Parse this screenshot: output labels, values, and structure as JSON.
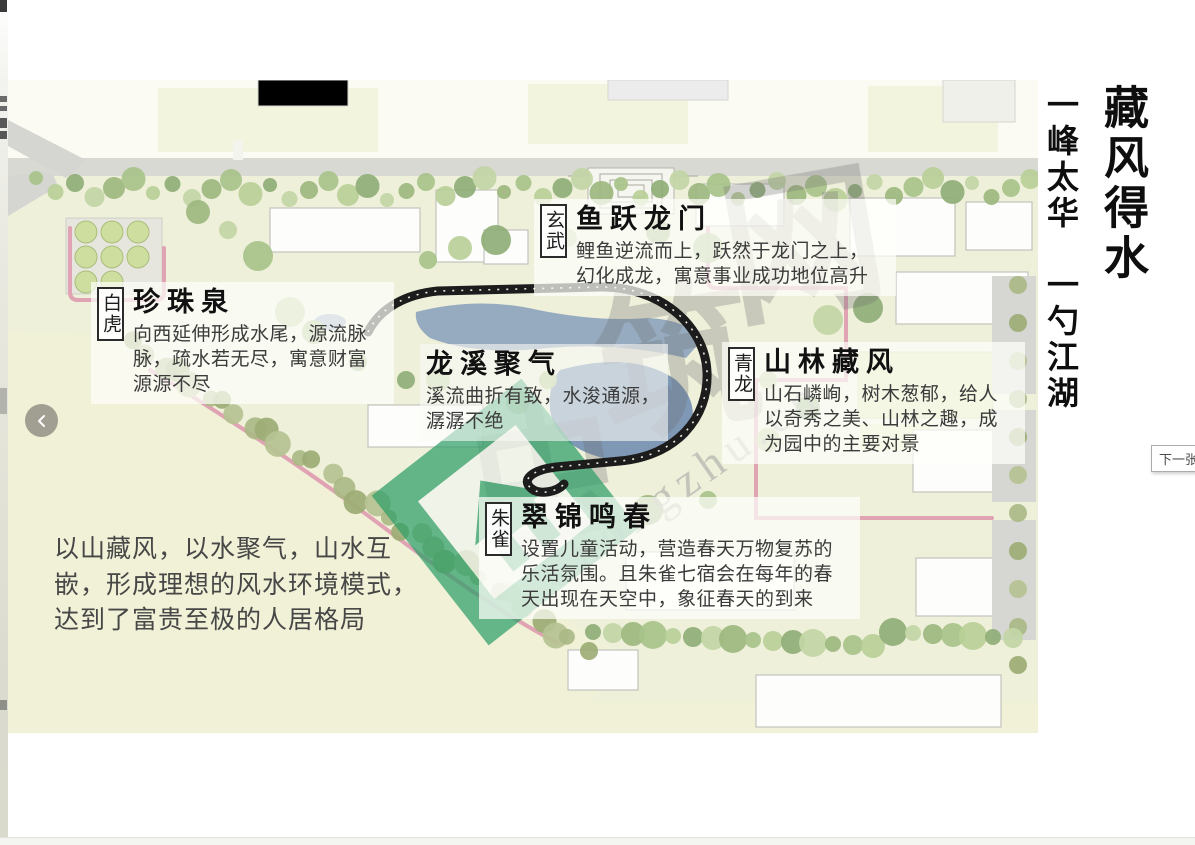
{
  "page": {
    "main_title": "藏风得水",
    "subtitle": "一峰太华　一勺江湖",
    "prev_button_symbol": "‹",
    "next_button_label": "下一张"
  },
  "annotations": {
    "xuanwu": {
      "badge": "玄武",
      "title": "鱼跃龙门",
      "body": "鲤鱼逆流而上，跃然于龙门之上，\n幻化成龙，寓意事业成功地位高升"
    },
    "baihu": {
      "badge": "白虎",
      "title": "珍珠泉",
      "body": "向西延伸形成水尾，源流脉\n脉，疏水若无尽，寓意财富\n源源不尽"
    },
    "longxi": {
      "title": "龙溪聚气",
      "body": "溪流曲折有致，水浚通源，\n潺潺不绝"
    },
    "qinglong": {
      "badge": "青龙",
      "title": "山林藏风",
      "body": "山石嶙峋，树木葱郁，给人\n以奇秀之美、山林之趣，成\n为园中的主要对景"
    },
    "zhuque": {
      "badge": "朱雀",
      "title": "翠锦鸣春",
      "body": "设置儿童活动，营造春天万物复苏的\n乐活氛围。且朱雀七宿会在每年的春\n天出现在天空中，象征春天的到来"
    }
  },
  "summary": "以山藏风，以水聚气，山水互\n嵌，形成理想的风水环境模式，\n达到了富贵至极的人居格局",
  "watermark": {
    "cn_chars": [
      "虫",
      "筑",
      "网"
    ],
    "en_text": "Chongzhu.cn"
  },
  "colors": {
    "field_cream": "#f1f1d7",
    "map_base": "#eef0da",
    "water_blue": "#7e98b5",
    "loop_black": "#1c1c1c",
    "path_pink": "#dfa3b4",
    "logo_green": "#2f9e68"
  }
}
